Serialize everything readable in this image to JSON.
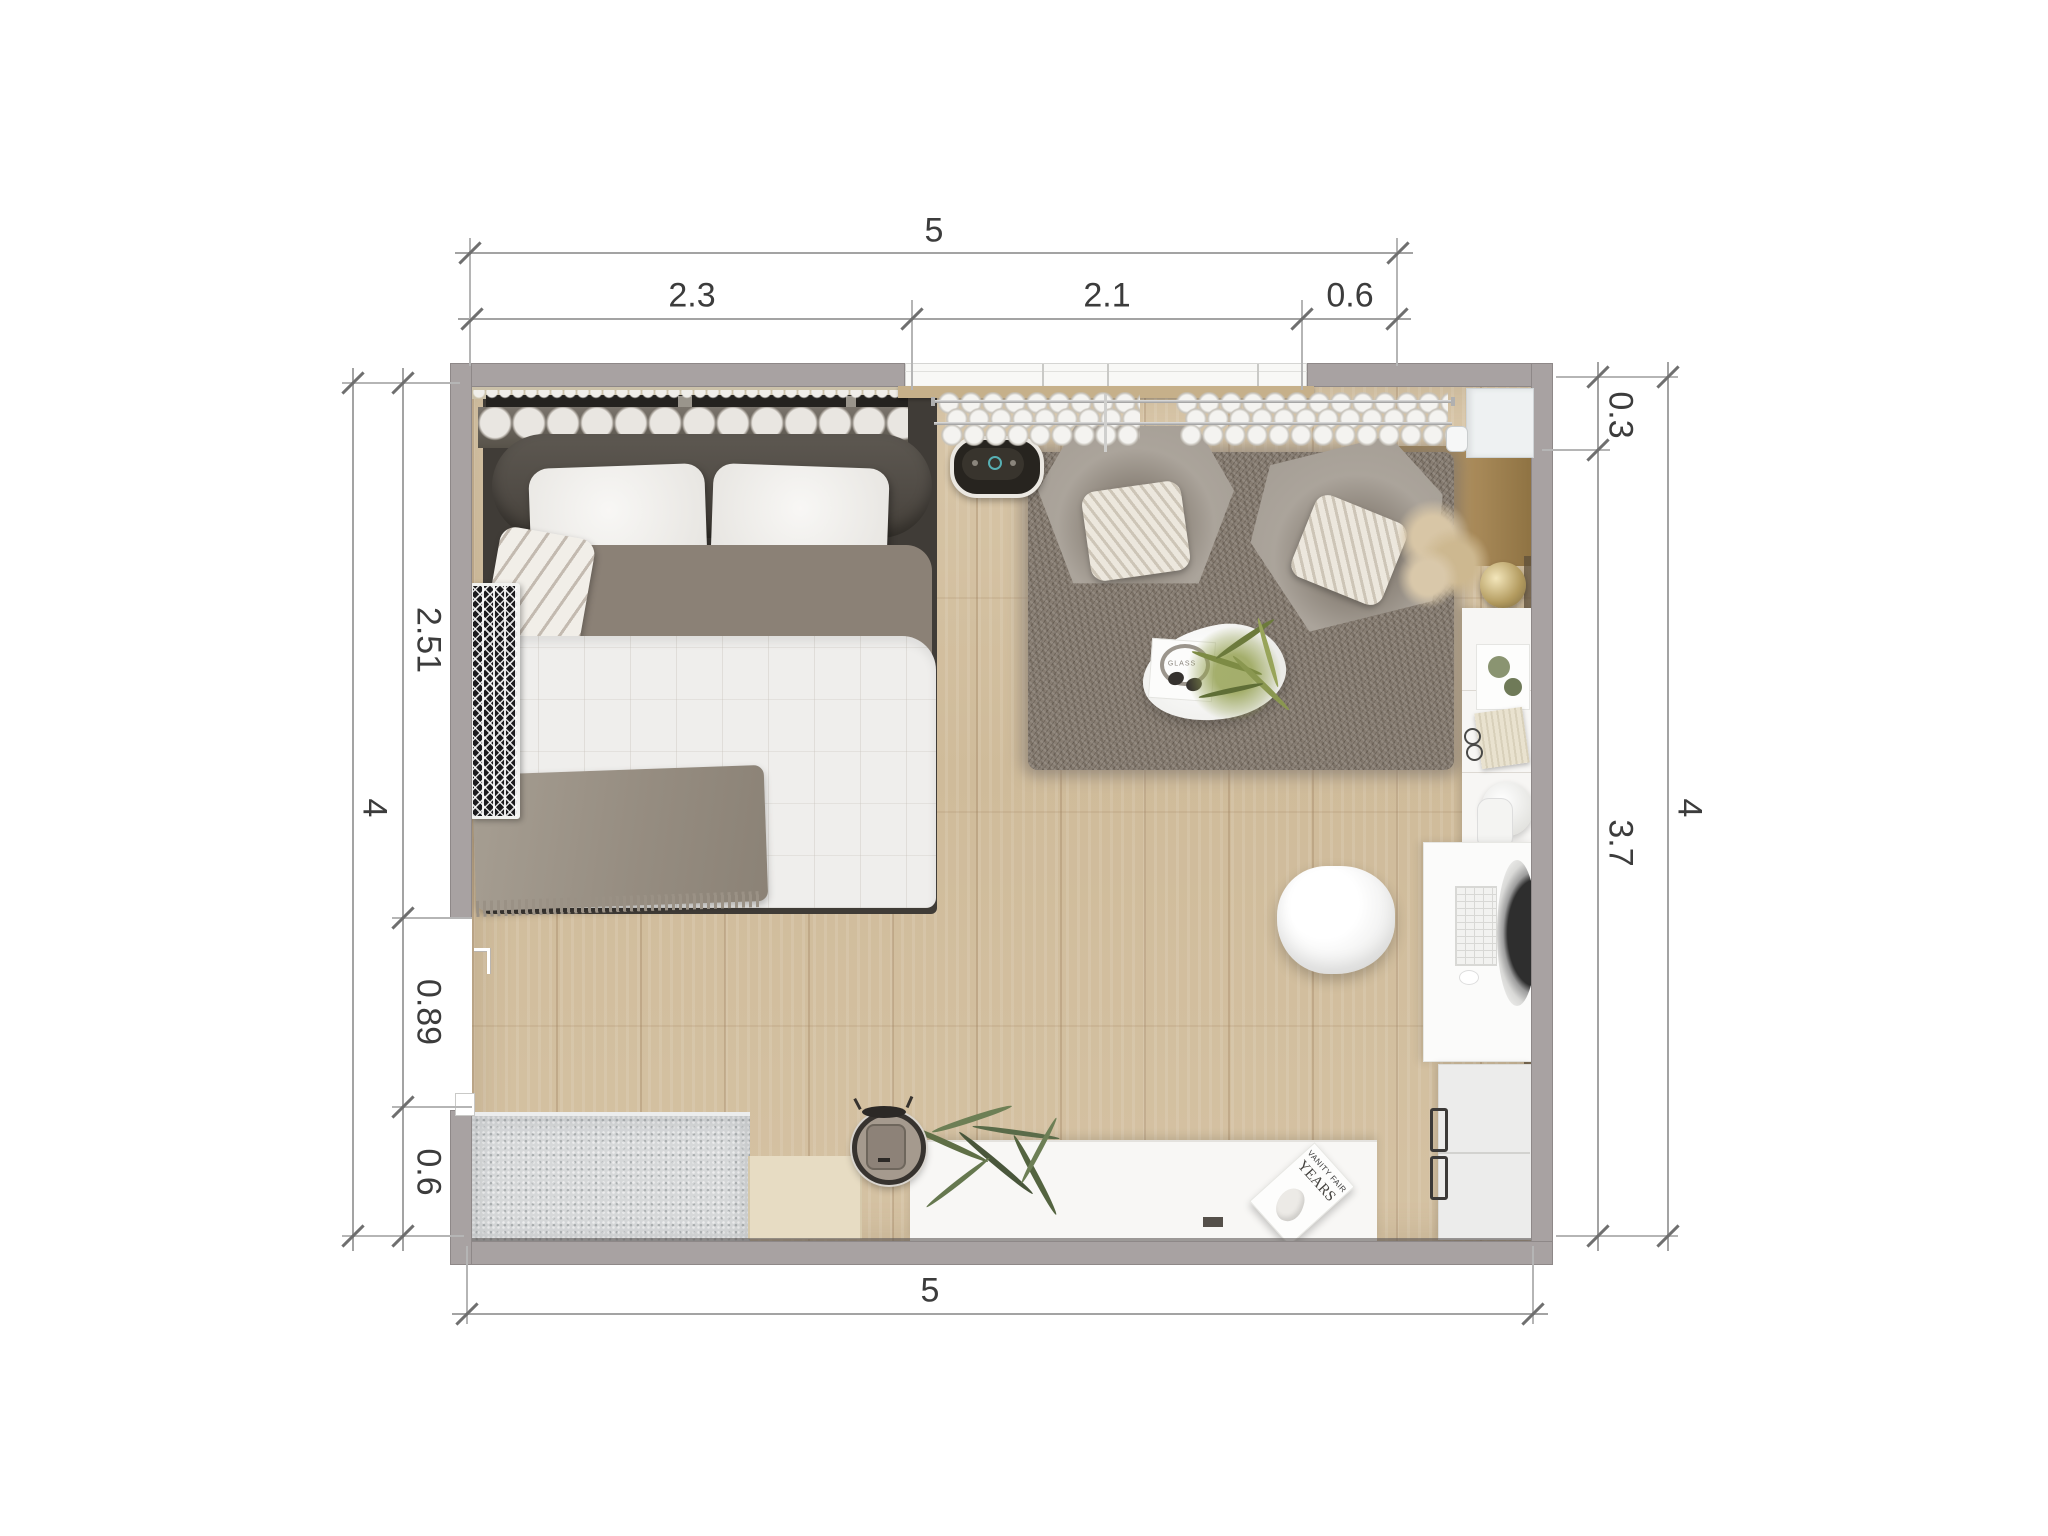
{
  "dimensions": {
    "top": {
      "overall": "5",
      "segments": [
        "2.3",
        "2.1",
        "0.6"
      ]
    },
    "bottom": {
      "overall": "5"
    },
    "left": {
      "overall": "4",
      "segments": [
        "2.51",
        "0.89",
        "0.6"
      ]
    },
    "right": {
      "overall": "4",
      "segments": [
        "0.3",
        "3.7"
      ]
    }
  },
  "decor_text": {
    "magazine_title": "VANITY FAIR",
    "magazine_subtitle": "YEARS",
    "tray_label": "GLASS"
  },
  "colors": {
    "wall": "#a8a2a2",
    "floor": "#d3bf9f",
    "rug": "#877d72",
    "armchair": "#a9a29a",
    "bed_duvet_grey": "#8b8176",
    "wood_counter": "#a3854f",
    "bench": "#d6d8d9"
  }
}
